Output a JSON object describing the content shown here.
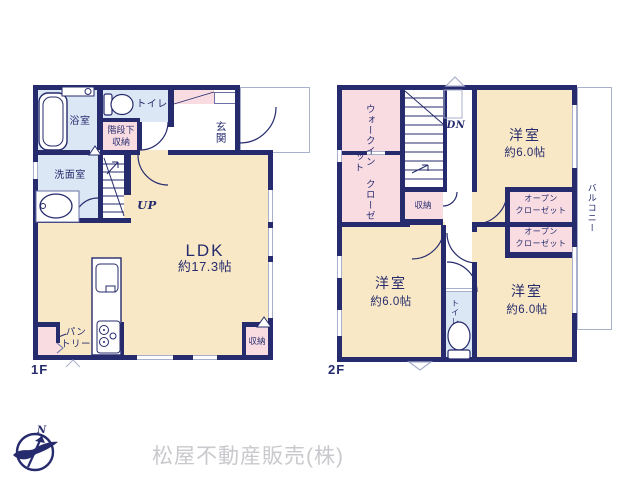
{
  "floor1": {
    "label": "1F",
    "bathroom": "浴室",
    "toilet": "トイレ",
    "stair_storage_line1": "階段下",
    "stair_storage_line2": "収納",
    "washroom": "洗面室",
    "entrance": "玄関",
    "stairs_up": "UP",
    "ldk_name": "LDK",
    "ldk_size": "約17.3帖",
    "pantry_line1": "パン",
    "pantry_line2": "トリー",
    "storage": "収納"
  },
  "floor2": {
    "label": "2F",
    "wic_line1": "ウォークイン",
    "wic_line2": "クローゼット",
    "stairs_down": "DN",
    "storage": "収納",
    "room_top_right_name": "洋室",
    "room_top_right_size": "約6.0帖",
    "open_closet1_line1": "オープン",
    "open_closet1_line2": "クローゼット",
    "open_closet2_line1": "オープン",
    "open_closet2_line2": "クローゼット",
    "room_bottom_left_name": "洋室",
    "room_bottom_left_size": "約6.0帖",
    "room_bottom_right_name": "洋室",
    "room_bottom_right_size": "約6.0帖",
    "toilet": "トイレ",
    "balcony": "バルコニー"
  },
  "branding": {
    "north_label": "N",
    "company_name": "松屋不動産販売(株)"
  },
  "colors": {
    "wall": "#262b6d",
    "room_cream": "#f8e8c6",
    "wet_blue": "#dbe7f4",
    "closet_pink": "#f8dce2",
    "window_gray": "#a9b0cc",
    "logo_text_gray": "#c9c9cd"
  }
}
